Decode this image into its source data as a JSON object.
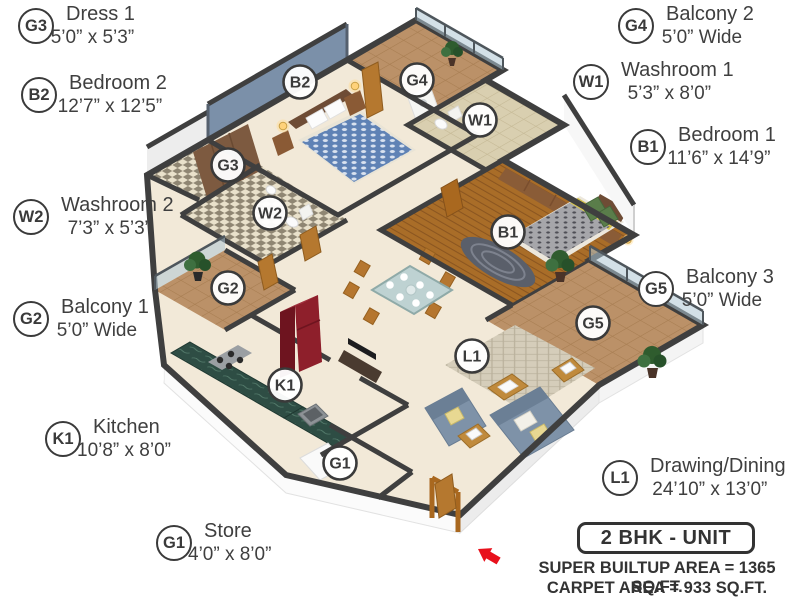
{
  "legend": {
    "left": [
      {
        "code": "G3",
        "name": "Dress 1",
        "dims": "5’0” x 5’3”"
      },
      {
        "code": "B2",
        "name": "Bedroom 2",
        "dims": "12’7” x 12’5”"
      },
      {
        "code": "W2",
        "name": "Washroom 2",
        "dims": "7’3” x 5’3”"
      },
      {
        "code": "G2",
        "name": "Balcony 1",
        "dims": "5’0” Wide"
      },
      {
        "code": "K1",
        "name": "Kitchen",
        "dims": "10’8” x 8’0”"
      },
      {
        "code": "G1",
        "name": "Store",
        "dims": "4’0” x 8’0”"
      }
    ],
    "right": [
      {
        "code": "G4",
        "name": "Balcony 2",
        "dims": "5’0” Wide"
      },
      {
        "code": "W1",
        "name": "Washroom 1",
        "dims": "5’3” x 8’0”"
      },
      {
        "code": "B1",
        "name": "Bedroom 1",
        "dims": "11’6” x 14’9”"
      },
      {
        "code": "G5",
        "name": "Balcony 3",
        "dims": "5’0” Wide"
      },
      {
        "code": "L1",
        "name": "Drawing/Dining",
        "dims": "24’10” x 13’0”"
      }
    ]
  },
  "markers": [
    {
      "code": "B2"
    },
    {
      "code": "G3"
    },
    {
      "code": "G4"
    },
    {
      "code": "W1"
    },
    {
      "code": "W2"
    },
    {
      "code": "B1"
    },
    {
      "code": "G2"
    },
    {
      "code": "G5"
    },
    {
      "code": "K1"
    },
    {
      "code": "L1"
    },
    {
      "code": "G1"
    }
  ],
  "footer": {
    "unit_label": "2 BHK - UNIT",
    "line1": "SUPER BUILTUP AREA = 1365 SQ.FT.",
    "line2": "CARPET AREA = 933 SQ.FT."
  },
  "palette": {
    "wall": "#3f3f3f",
    "floor_cream": "#f2e9d8",
    "wood_floor": "#a96d28",
    "balcony_tile": "#bb9168",
    "accent_wall_blue": "#7b90a9",
    "kitchen_counter_green": "#2e4d44",
    "fridge_red": "#8e1f2b",
    "sofa_blue_grey": "#7e92a8",
    "bed2_duvet_blue": "#5f82b5",
    "bed1_duvet_grey": "#a6a6aa",
    "pillow_green": "#5a7d4a",
    "text_grey": "#3f3f3f",
    "entrance_arrow_red": "#e8111c"
  }
}
